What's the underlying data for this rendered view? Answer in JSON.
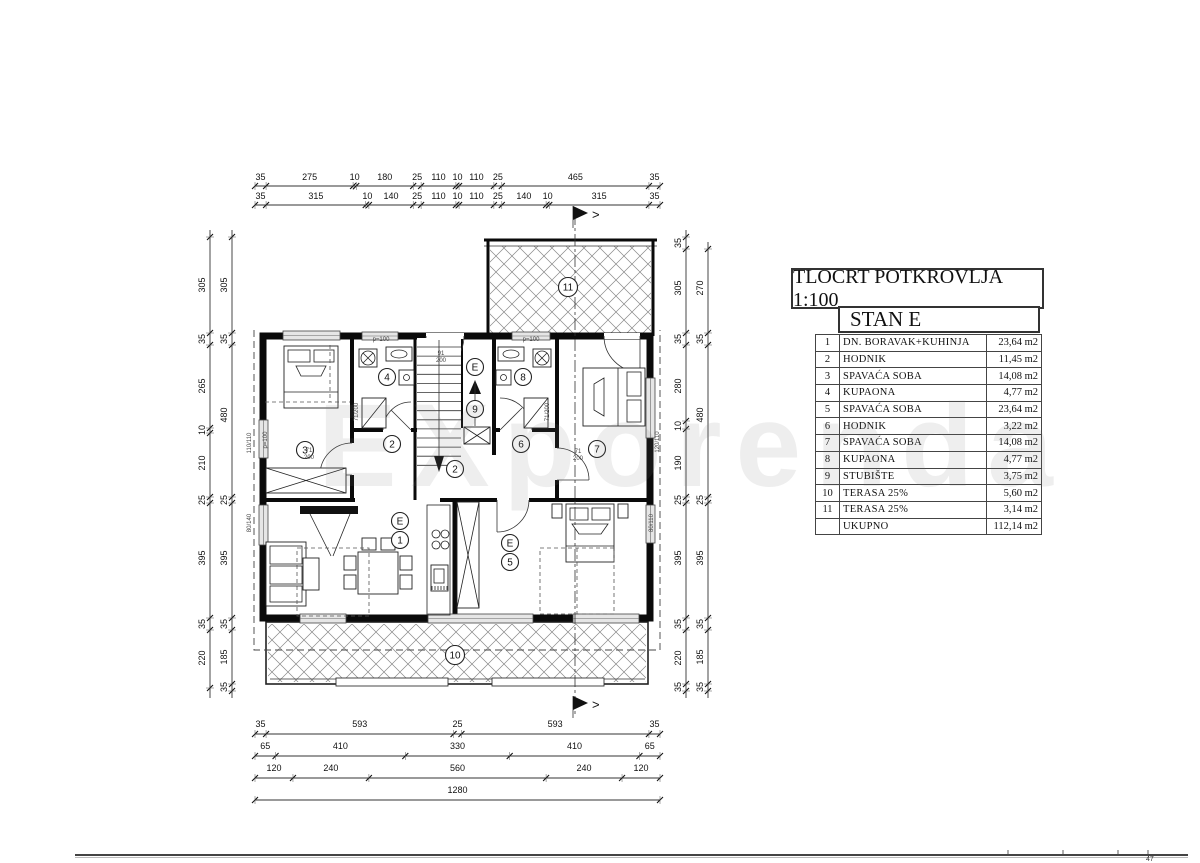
{
  "page_number": "47",
  "watermark": "EXporenda",
  "legend": {
    "title": "TLOCRT POTKROVLJA 1:100",
    "unit": "STAN E",
    "rows": [
      {
        "num": "1",
        "name": "DN. BORAVAK+KUHINJA",
        "area": "23,64 m2"
      },
      {
        "num": "2",
        "name": "HODNIK",
        "area": "11,45 m2"
      },
      {
        "num": "3",
        "name": "SPAVAĆA SOBA",
        "area": "14,08 m2"
      },
      {
        "num": "4",
        "name": "KUPAONA",
        "area": "4,77 m2"
      },
      {
        "num": "5",
        "name": "SPAVAĆA SOBA",
        "area": "23,64 m2"
      },
      {
        "num": "6",
        "name": "HODNIK",
        "area": "3,22 m2"
      },
      {
        "num": "7",
        "name": "SPAVAĆA SOBA",
        "area": "14,08 m2"
      },
      {
        "num": "8",
        "name": "KUPAONA",
        "area": "4,77 m2"
      },
      {
        "num": "9",
        "name": "STUBIŠTE",
        "area": "3,75 m2"
      },
      {
        "num": "10",
        "name": "TERASA 25%",
        "area": "5,60 m2"
      },
      {
        "num": "11",
        "name": "TERASA 25%",
        "area": "3,14 m2"
      },
      {
        "num": "",
        "name": "UKUPNO",
        "area": "112,14 m2"
      }
    ]
  },
  "plan": {
    "section_marker": ">",
    "h_dims": [
      {
        "line_y": 186,
        "text_y": 180,
        "x0": 255,
        "x1": 660,
        "segs": [
          35,
          275,
          10,
          180,
          25,
          110,
          10,
          110,
          25,
          465,
          35
        ]
      },
      {
        "line_y": 205,
        "text_y": 199,
        "x0": 255,
        "x1": 660,
        "segs": [
          35,
          315,
          10,
          140,
          25,
          110,
          10,
          110,
          25,
          140,
          10,
          315,
          35
        ]
      },
      {
        "line_y": 734,
        "text_y": 727,
        "x0": 255,
        "x1": 660,
        "segs": [
          35,
          593,
          25,
          593,
          35
        ]
      },
      {
        "line_y": 756,
        "text_y": 749,
        "x0": 255,
        "x1": 660,
        "segs": [
          65,
          410,
          330,
          410,
          65
        ]
      },
      {
        "line_y": 778,
        "text_y": 771,
        "x0": 255,
        "x1": 660,
        "segs": [
          120,
          240,
          560,
          240,
          120
        ]
      },
      {
        "line_y": 800,
        "text_y": 793,
        "x0": 255,
        "x1": 660,
        "segs": [
          1280
        ]
      }
    ],
    "v_dims": [
      {
        "x": 210,
        "y0": 230,
        "y1": 698,
        "labels": [
          [
            "305",
            285
          ],
          [
            "35",
            339
          ],
          [
            "265",
            386
          ],
          [
            "10",
            430
          ],
          [
            "210",
            463
          ],
          [
            "25",
            500
          ],
          [
            "395",
            558
          ],
          [
            "35",
            624
          ],
          [
            "220",
            658
          ]
        ],
        "ticks": [
          237,
          333,
          345,
          428,
          433,
          497,
          503,
          618,
          630,
          688
        ]
      },
      {
        "x": 232,
        "y0": 230,
        "y1": 698,
        "labels": [
          [
            "305",
            285
          ],
          [
            "35",
            339
          ],
          [
            "480",
            415
          ],
          [
            "25",
            500
          ],
          [
            "395",
            558
          ],
          [
            "35",
            624
          ],
          [
            "185",
            657
          ],
          [
            "35",
            687
          ]
        ],
        "ticks": [
          237,
          333,
          345,
          497,
          503,
          618,
          630,
          684,
          691
        ]
      },
      {
        "x": 686,
        "y0": 230,
        "y1": 698,
        "labels": [
          [
            "35",
            243
          ],
          [
            "305",
            288
          ],
          [
            "35",
            339
          ],
          [
            "280",
            386
          ],
          [
            "10",
            426
          ],
          [
            "190",
            463
          ],
          [
            "25",
            500
          ],
          [
            "395",
            558
          ],
          [
            "35",
            624
          ],
          [
            "220",
            658
          ],
          [
            "35",
            687
          ]
        ],
        "ticks": [
          237,
          249,
          333,
          345,
          421,
          429,
          497,
          503,
          618,
          630,
          684,
          691
        ]
      },
      {
        "x": 708,
        "y0": 242,
        "y1": 698,
        "labels": [
          [
            "270",
            288
          ],
          [
            "35",
            339
          ],
          [
            "480",
            415
          ],
          [
            "25",
            500
          ],
          [
            "395",
            558
          ],
          [
            "35",
            624
          ],
          [
            "185",
            657
          ],
          [
            "35",
            687
          ]
        ],
        "ticks": [
          249,
          333,
          345,
          497,
          503,
          618,
          630,
          684,
          691
        ]
      }
    ],
    "room_markers": [
      {
        "label": "11",
        "x": 568,
        "y": 287
      },
      {
        "label": "3",
        "x": 305,
        "y": 450
      },
      {
        "label": "4",
        "x": 387,
        "y": 377
      },
      {
        "label": "8",
        "x": 523,
        "y": 377
      },
      {
        "label": "E",
        "x": 475,
        "y": 367
      },
      {
        "label": "9",
        "x": 475,
        "y": 409
      },
      {
        "label": "2",
        "x": 392,
        "y": 444
      },
      {
        "label": "6",
        "x": 521,
        "y": 444
      },
      {
        "label": "2",
        "x": 455,
        "y": 469
      },
      {
        "label": "7",
        "x": 597,
        "y": 449
      },
      {
        "label": "E",
        "x": 400,
        "y": 521
      },
      {
        "label": "1",
        "x": 400,
        "y": 540
      },
      {
        "label": "E",
        "x": 510,
        "y": 543
      },
      {
        "label": "5",
        "x": 510,
        "y": 562
      },
      {
        "label": "10",
        "x": 455,
        "y": 655
      }
    ],
    "annotations": [
      {
        "t": "91",
        "x": 441,
        "y": 355,
        "r": 0
      },
      {
        "t": "200",
        "x": 441,
        "y": 362,
        "r": 0
      },
      {
        "t": "71",
        "x": 309,
        "y": 452,
        "r": 0
      },
      {
        "t": "200",
        "x": 309,
        "y": 459,
        "r": 0
      },
      {
        "t": "71",
        "x": 578,
        "y": 453,
        "r": 0
      },
      {
        "t": "200",
        "x": 578,
        "y": 460,
        "r": 0
      },
      {
        "t": "71/200",
        "x": 358,
        "y": 412,
        "r": -90
      },
      {
        "t": "71/200",
        "x": 549,
        "y": 412,
        "r": -90
      },
      {
        "t": "p=100",
        "x": 381,
        "y": 341,
        "r": 0
      },
      {
        "t": "p=100",
        "x": 531,
        "y": 341,
        "r": 0
      },
      {
        "t": "p=100",
        "x": 267,
        "y": 440,
        "r": -90
      },
      {
        "t": "110/110",
        "x": 251,
        "y": 443,
        "r": -90
      },
      {
        "t": "80/140",
        "x": 251,
        "y": 523,
        "r": -90
      },
      {
        "t": "120/110",
        "x": 659,
        "y": 442,
        "r": -90
      },
      {
        "t": "80/110",
        "x": 653,
        "y": 523,
        "r": -90
      }
    ]
  }
}
